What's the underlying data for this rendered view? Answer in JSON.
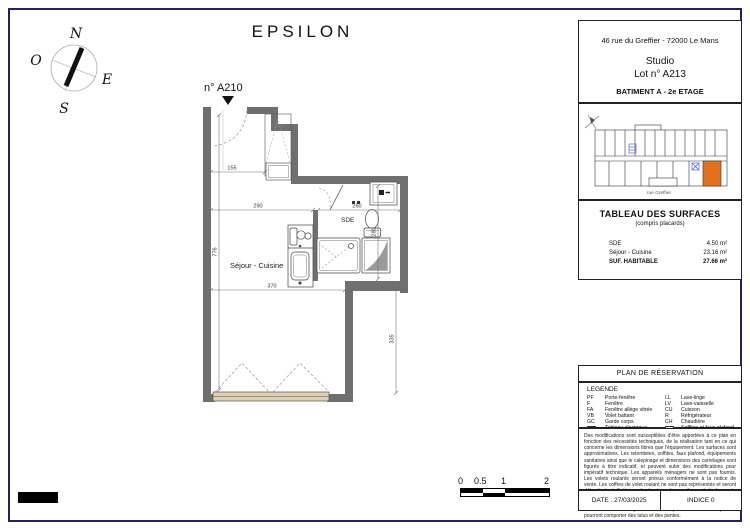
{
  "title": "EPSILON",
  "compass": {
    "n": "N",
    "e": "E",
    "s": "S",
    "o": "O"
  },
  "plan": {
    "unit_label": "n° A210",
    "room_sejour": "Séjour - Cuisine",
    "room_sde": "SDE",
    "dims": {
      "entry": "155",
      "sejour_w": "290",
      "sde_w": "260",
      "sde_h": "280",
      "sejour_w2": "370",
      "sejour_h": "335",
      "total_h": "776"
    }
  },
  "scalebar": {
    "labels": [
      "0",
      "0.5",
      "1",
      "2"
    ]
  },
  "titleblock": {
    "address": "46 rue du Greffier - 72000 Le Mans",
    "program": "Studio",
    "lot": "Lot n° A213",
    "building": "BATIMENT A - 2e ETAGE",
    "keyplan": {
      "street": "rue Greffier"
    },
    "surfaces": {
      "title": "TABLEAU DES SURFACES",
      "subtitle": "(compris placards)",
      "rows": [
        {
          "label": "SDE",
          "value": "4.50 m²"
        },
        {
          "label": "Séjour - Cuisine",
          "value": "23.16 m²"
        },
        {
          "label": "SUF. HABITABLE",
          "value": "27.66 m²"
        }
      ]
    },
    "reservation_title": "PLAN DE RÉSERVATION",
    "legend": {
      "title": "LEGENDE",
      "rows": [
        {
          "a1": "PF",
          "t1": "Porte-fenêtre",
          "a2": "LL",
          "t2": "Lave-linge"
        },
        {
          "a1": "F",
          "t1": "Fenêtre",
          "a2": "LV",
          "t2": "Lave-vaisselle"
        },
        {
          "a1": "FA",
          "t1": "Fenêtre allège vitrée",
          "a2": "CU",
          "t2": "Cuisson"
        },
        {
          "a1": "VB",
          "t1": "Volet battant",
          "a2": "R",
          "t2": "Réfrigérateur"
        },
        {
          "a1": "GC",
          "t1": "Garde corps",
          "a2": "CH",
          "t2": "Chaudière"
        },
        {
          "a1": "",
          "t1": "Tableau électrique",
          "a2": "",
          "t2": "Soffites et faux-plafond"
        }
      ]
    },
    "disclaimer": "Des modifications sont susceptibles d'être apportées à ce plan en fonction des nécessités techniques, de la réalisation tant en ce qui concerne les dimensions libres que l'équipement. Les surfaces sont approximatives. Les retombées, soffites, faux plafond, équipements sanitaires ainsi que le calepinage et dimensions des carrelages sont figurés à titre indicatif, et peuvent subir des modifications pour impératif technique. Les appareils ménagers ne sont pas fournis. Les volets roulants seront prévus conformément à la notice de vente. Les coffres de volet roulant ne sont pas représentés et seront débordants à l'intérieur. La hauteur des seuils au droit des porte fenêtres sur balcons ou terrasses pourra varier de 5 à 20 cm à partir du sol intérieur. La hauteur entre le jardin et la terrasse pourra varier entre 0 et 60 cm. Les jardins ne seront pas nécessairement plats et pourront comporter des talus et des pentes.",
    "date": "DATE : 27/03/2025",
    "indice": "INDICE 0"
  }
}
